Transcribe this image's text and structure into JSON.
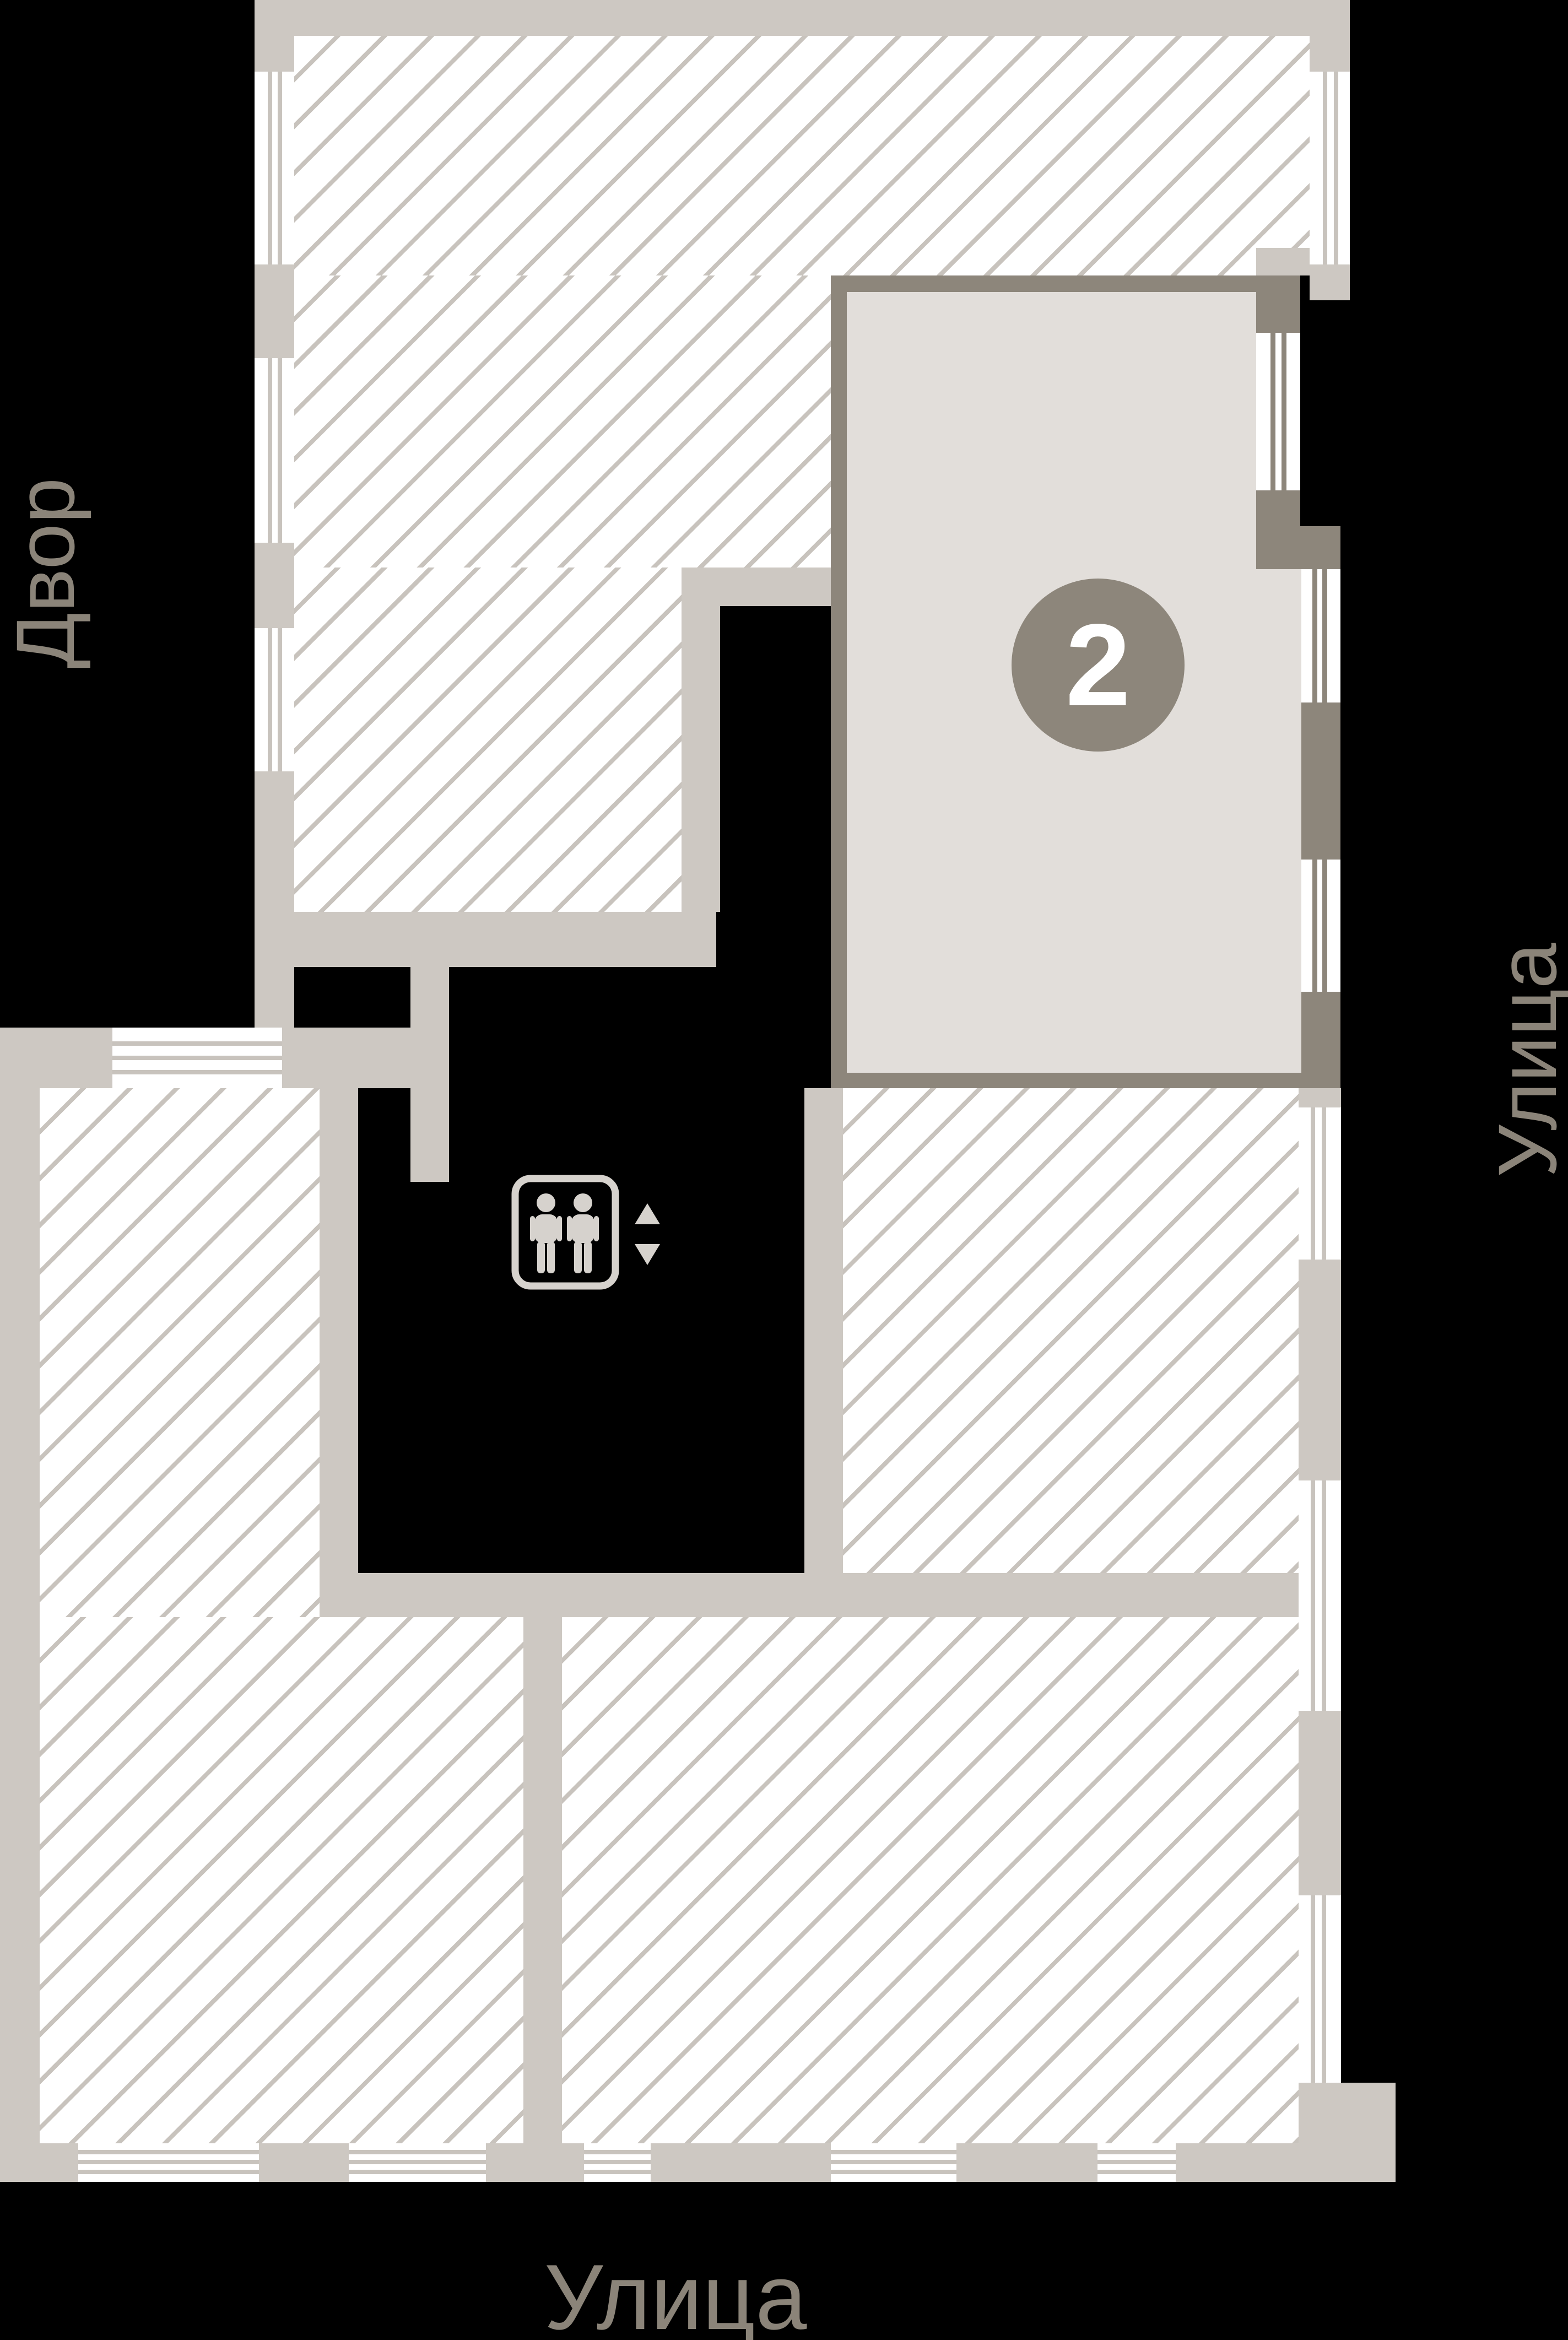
{
  "labels": {
    "courtyard": "Двор",
    "street_right": "Улица",
    "street_bottom": "Улица"
  },
  "selected_unit": {
    "number": "2"
  },
  "icons": {
    "elevator": "elevator-passengers-icon",
    "up_arrow": "elevator-up-arrow-icon",
    "down_arrow": "elevator-down-arrow-icon"
  },
  "colors": {
    "background": "#000000",
    "wall": "#cdc8c2",
    "hatch_line": "#c8c3bd",
    "selected_border": "#8d867b",
    "selected_fill": "#e2deda",
    "badge": "#8d867b",
    "badge_text": "#ffffff",
    "label_text": "#8b8479",
    "elevator_icon": "#d6d2cd"
  }
}
